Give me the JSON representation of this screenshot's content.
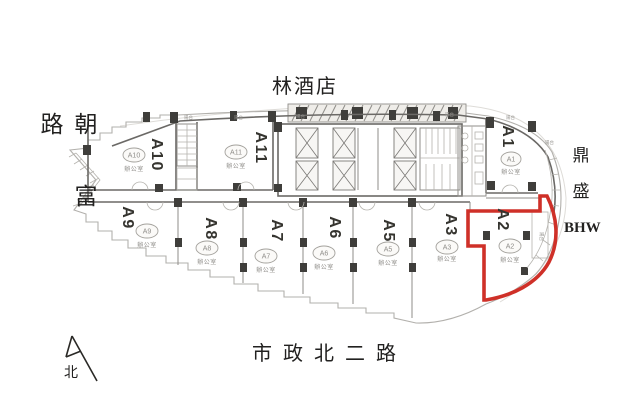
{
  "floor_plan": {
    "hotel": "林酒店",
    "left_road": "朝富路",
    "right_landmark": {
      "line1": "鼎",
      "line2": "盛",
      "line3": "BHW"
    },
    "bottom_road": "市政北二路",
    "compass_north": "北",
    "balcony": "陽台",
    "highlight": {
      "unit": "A2",
      "color": "#cf3028"
    },
    "units": [
      {
        "id": "A10",
        "use": "辦公室"
      },
      {
        "id": "A11",
        "use": "辦公室"
      },
      {
        "id": "A1",
        "use": "辦公室"
      },
      {
        "id": "A9",
        "use": "辦公室"
      },
      {
        "id": "A8",
        "use": "辦公室"
      },
      {
        "id": "A7",
        "use": "辦公室"
      },
      {
        "id": "A6",
        "use": "辦公室"
      },
      {
        "id": "A5",
        "use": "辦公室"
      },
      {
        "id": "A3",
        "use": "辦公室"
      },
      {
        "id": "A2",
        "use": "辦公室"
      }
    ]
  }
}
